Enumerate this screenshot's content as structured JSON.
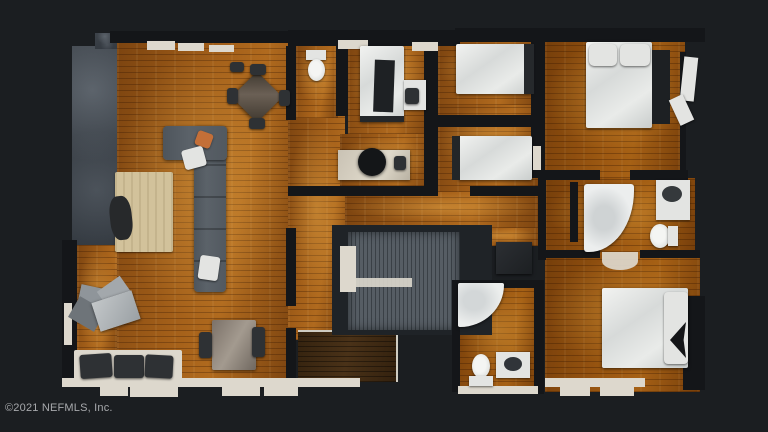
{
  "watermark": {
    "text": "©2021 NEFMLS, Inc."
  },
  "scene": {
    "type": "real-estate-3d-floor-plan-top-view",
    "description": "Top-down dollhouse scan of an apartment with amber wood floors on a dark background",
    "rooms": [
      "patio",
      "living-room",
      "dining-area",
      "kitchen-counter",
      "half-bath",
      "small-bedroom",
      "office",
      "middle-bedroom-upper",
      "middle-bedroom-lower",
      "right-bedroom",
      "right-bathroom",
      "bottom-bathroom",
      "bottom-right-bedroom",
      "stairwell",
      "entry-hall"
    ]
  },
  "colors": {
    "background": "#1b1e21",
    "watermark_text": "#a7a9ac",
    "wood_base": "#a35f19",
    "wood_dark": "#7c4410",
    "wall_dark": "#141619",
    "wall_light": "#ddd8cd",
    "patio": "#3d434a",
    "sofa": "#5b6269",
    "rug": "#d2c29b",
    "stairs": "#4a5056",
    "stair_pit": "#1f2327",
    "furniture_white": "#e3e4e2",
    "entry_wood": "#4a3218",
    "accent_pillow": "#c46f38"
  }
}
